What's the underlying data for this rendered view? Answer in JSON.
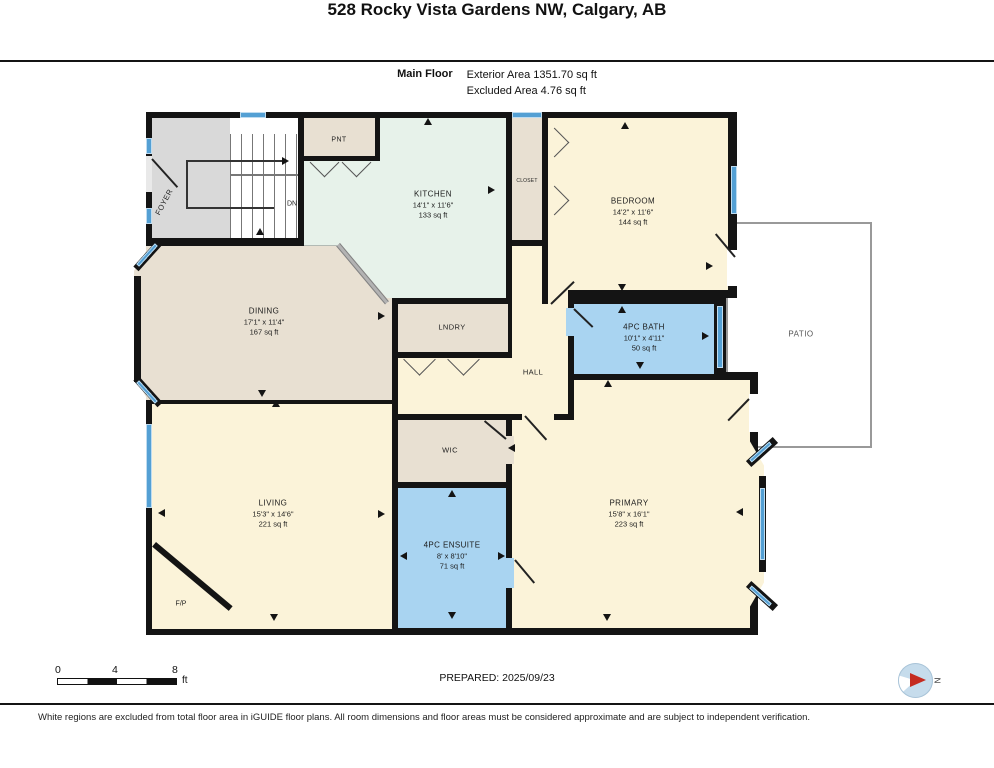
{
  "header": {
    "title": "528 Rocky Vista Gardens NW, Calgary, AB",
    "floor_label": "Main Floor",
    "exterior_area": "Exterior Area 1351.70 sq ft",
    "excluded_area": "Excluded Area 4.76 sq ft"
  },
  "rooms": {
    "kitchen": {
      "name": "KITCHEN",
      "dims": "14'1\" x 11'6\"",
      "area": "133 sq ft"
    },
    "bedroom": {
      "name": "BEDROOM",
      "dims": "14'2\" x 11'6\"",
      "area": "144 sq ft"
    },
    "dining": {
      "name": "DINING",
      "dims": "17'1\" x 11'4\"",
      "area": "167 sq ft"
    },
    "bath": {
      "name": "4PC BATH",
      "dims": "10'1\" x 4'11\"",
      "area": "50 sq ft"
    },
    "living": {
      "name": "LIVING",
      "dims": "15'3\" x 14'6\"",
      "area": "221 sq ft"
    },
    "ensuite": {
      "name": "4PC ENSUITE",
      "dims": "8' x 8'10\"",
      "area": "71 sq ft"
    },
    "primary": {
      "name": "PRIMARY",
      "dims": "15'8\" x 16'1\"",
      "area": "223 sq ft"
    },
    "pnt": {
      "label": "PNT"
    },
    "closet": {
      "label": "CLOSET"
    },
    "lndry": {
      "label": "LNDRY"
    },
    "hall": {
      "label": "HALL"
    },
    "wic": {
      "label": "WIC"
    },
    "foyer": {
      "label": "FOYER"
    },
    "patio": {
      "label": "PATIO"
    },
    "fireplace": {
      "label": "F/P"
    },
    "stairs": {
      "dn_label": "DN"
    }
  },
  "footer": {
    "scale": {
      "t0": "0",
      "t4": "4",
      "t8": "8",
      "unit": "ft"
    },
    "prepared": "PREPARED: 2025/09/23",
    "compass_n": "N",
    "disclaimer": "White regions are excluded from total floor area in iGUIDE floor plans. All room dimensions and floor areas must be considered approximate and are subject to independent verification."
  },
  "colors": {
    "wall": "#141414",
    "room_cream": "#fbf3d9",
    "room_tan": "#e8e0d2",
    "room_mint": "#e7f2ea",
    "room_blue": "#a9d4f1",
    "window_blue": "#54a0d4",
    "foyer_gray": "#d9d9d9",
    "compass_red": "#c52b20"
  }
}
